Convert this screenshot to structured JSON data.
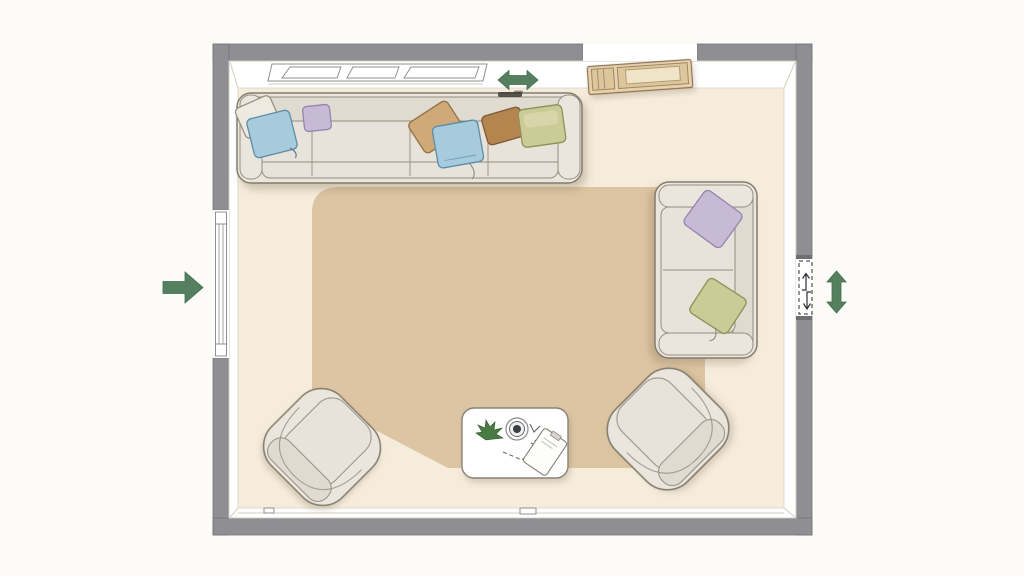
{
  "scene": {
    "description": "Top-down floor plan of a living room with sectional sofa, loveseat, two armchairs, coffee table and area rug"
  },
  "colors": {
    "bg": "#fcfbf8",
    "wall": "#8e8e93",
    "wall_edge": "#74747a",
    "inner_face": "#ffffff",
    "face_line": "#d2ccc1",
    "floor": "#f5ecdc",
    "floor_line": "#ded7c9",
    "rug": "#dcc5a2",
    "sofa": "#eae6de",
    "sofa_seat": "#e7e3da",
    "sofa_back": "#e0dbd1",
    "sofa_line": "#958d7d",
    "sofa_outline": "#847c6c",
    "pillow_cream": "#efeae1",
    "pillow_cream_outline": "#9a9183",
    "pillow_blue": "#a6cbdd",
    "pillow_blue_outline": "#5d8ca6",
    "pillow_lavender": "#c7bad6",
    "pillow_lavender_outline": "#9684ad",
    "pillow_khaki": "#cfa977",
    "pillow_khaki_outline": "#8f7245",
    "pillow_brown": "#b5854f",
    "pillow_brown_outline": "#7d5a33",
    "pillow_olive": "#cbcb97",
    "pillow_olive_outline": "#8f9156",
    "wood": "#e7d1ab",
    "wood_dark": "#dcc69b",
    "wood_screen": "#efe3c8",
    "wood_outline": "#8d7353",
    "table_outline": "#8a8276",
    "plant": "#4a7b43",
    "plant_dark": "#2e5128",
    "arrow": "#54805f",
    "arrow_dark": "#3f6d4c",
    "ink": "#2e2e2e",
    "smudge": "#3e3a34"
  },
  "fixtures": [
    {
      "id": "window",
      "wall": "top"
    },
    {
      "id": "window",
      "wall": "left"
    },
    {
      "id": "wall-opening",
      "wall": "top"
    },
    {
      "id": "door-opening",
      "wall": "right",
      "style": "dashed"
    }
  ],
  "furniture": [
    {
      "id": "sectional-sofa",
      "wall": "top",
      "pillows": [
        "cream",
        "blue",
        "lavender",
        "khaki",
        "blue",
        "brown",
        "olive"
      ]
    },
    {
      "id": "loveseat",
      "wall": "right",
      "pillows": [
        "lavender",
        "olive"
      ]
    },
    {
      "id": "armchair",
      "position": "bottom-left"
    },
    {
      "id": "armchair",
      "position": "bottom-right"
    },
    {
      "id": "coffee-table",
      "items": [
        "plant",
        "bowl",
        "sketch-marks",
        "notepad"
      ]
    },
    {
      "id": "area-rug"
    },
    {
      "id": "media-console",
      "wall": "top"
    }
  ],
  "annotations": {
    "arrows": [
      {
        "id": "entry-arrow",
        "side": "left-exterior",
        "direction": "right"
      },
      {
        "id": "window-slide-arrow",
        "side": "top-interior",
        "direction": "left-right"
      },
      {
        "id": "door-swing-arrow",
        "side": "right-exterior",
        "direction": "up-down"
      },
      {
        "id": "door-mini-arrows",
        "side": "in-door-opening",
        "direction": "up-down"
      }
    ]
  }
}
